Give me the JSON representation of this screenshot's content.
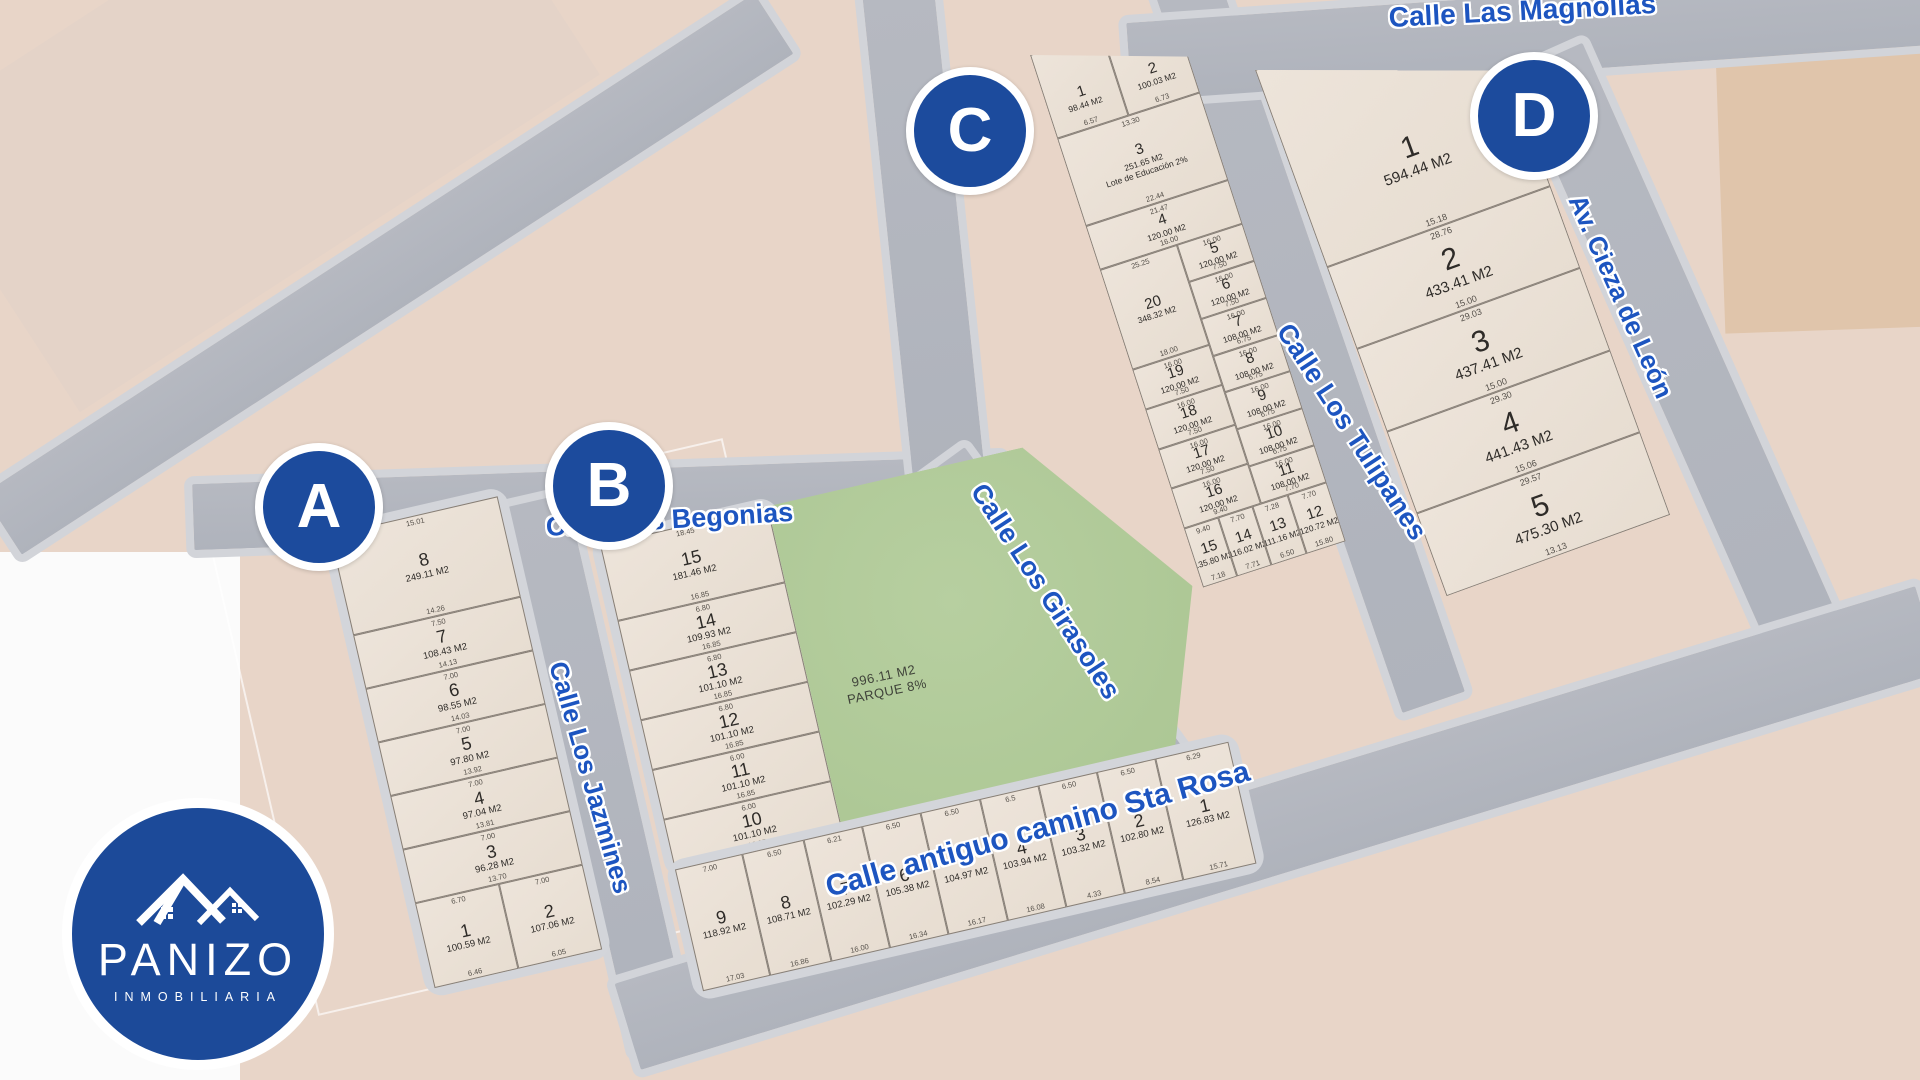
{
  "brand": {
    "name": "PANIZO",
    "subtitle": "INMOBILIARIA"
  },
  "colors": {
    "marker_blue": "#1c4b9d",
    "street_label_blue": "#1d55c0",
    "park_green": "#b2cb9b",
    "road_gray": "#b4b7c0",
    "lot_beige": "#eae1d6"
  },
  "park": {
    "area": "996.11 M2",
    "label": "PARQUE 8%"
  },
  "streets": {
    "begonias": "Calle Las Begonias",
    "jazmines": "Calle Los Jazmines",
    "girasoles": "Calle Los Girasoles",
    "tulipanes": "Calle Los Tulipanes",
    "magnolias": "Calle Las Magnolias",
    "cieza": "Av. Cieza de León",
    "sta_rosa": "Calle antiguo camino Sta Rosa"
  },
  "blocks": {
    "A": {
      "label": "A",
      "lots": [
        {
          "n": "8",
          "area": "249.11 M2",
          "dims": [
            "15.01",
            "14.26"
          ]
        },
        {
          "n": "7",
          "area": "108.43 M2",
          "dims": [
            "7.50",
            "14.13"
          ]
        },
        {
          "n": "6",
          "area": "98.55 M2",
          "dims": [
            "7.00",
            "14.03"
          ]
        },
        {
          "n": "5",
          "area": "97.80 M2",
          "dims": [
            "7.00",
            "13.92"
          ]
        },
        {
          "n": "4",
          "area": "97.04 M2",
          "dims": [
            "7.00",
            "13.81"
          ]
        },
        {
          "n": "3",
          "area": "96.28 M2",
          "dims": [
            "7.00",
            "13.70"
          ]
        },
        {
          "n": "2",
          "area": "107.06 M2",
          "dims": [
            "7.00",
            "6.05"
          ]
        },
        {
          "n": "1",
          "area": "100.59 M2",
          "dims": [
            "6.70",
            "6.46"
          ]
        }
      ]
    },
    "B": {
      "label": "B",
      "lots": [
        {
          "n": "15",
          "area": "181.46 M2",
          "dims": [
            "18.45",
            "16.85"
          ]
        },
        {
          "n": "14",
          "area": "109.93 M2",
          "dims": [
            "6.80",
            "16.85"
          ]
        },
        {
          "n": "13",
          "area": "101.10 M2",
          "dims": [
            "6.80",
            "16.85"
          ]
        },
        {
          "n": "12",
          "area": "101.10 M2",
          "dims": [
            "6.80",
            "16.85"
          ]
        },
        {
          "n": "11",
          "area": "101.10 M2",
          "dims": [
            "6.00",
            "16.85"
          ]
        },
        {
          "n": "10",
          "area": "101.10 M2",
          "dims": [
            "6.00",
            "16.85"
          ]
        },
        {
          "n": "9",
          "area": "118.92 M2",
          "dims": [
            "7.00",
            "17.03"
          ]
        },
        {
          "n": "8",
          "area": "108.71 M2",
          "dims": [
            "6.50",
            "16.86"
          ]
        },
        {
          "n": "7",
          "area": "102.29 M2",
          "dims": [
            "6.21",
            "16.00"
          ]
        },
        {
          "n": "6",
          "area": "105.38 M2",
          "dims": [
            "6.50",
            "16.34"
          ]
        },
        {
          "n": "5",
          "area": "104.97 M2",
          "dims": [
            "6.50",
            "16.17"
          ]
        },
        {
          "n": "4",
          "area": "103.94 M2",
          "dims": [
            "6.5",
            "16.08"
          ]
        },
        {
          "n": "3",
          "area": "103.32 M2",
          "dims": [
            "6.50",
            "4.33"
          ]
        },
        {
          "n": "2",
          "area": "102.80 M2",
          "dims": [
            "6.50",
            "8.54"
          ]
        },
        {
          "n": "1",
          "area": "126.83 M2",
          "dims": [
            "6.29",
            "15.71"
          ]
        }
      ]
    },
    "C": {
      "label": "C",
      "lots": [
        {
          "n": "1",
          "area": "98.44 M2",
          "dims": [
            "6.90",
            "6.57"
          ]
        },
        {
          "n": "2",
          "area": "100.03 M2",
          "dims": [
            "6.74",
            "6.73"
          ]
        },
        {
          "n": "3",
          "area": "251.65 M2",
          "note": "Lote de Educación 2%",
          "dims": [
            "13.30",
            "22.44"
          ]
        },
        {
          "n": "4",
          "area": "120.00 M2",
          "dims": [
            "21.47",
            "16.00"
          ]
        },
        {
          "n": "5",
          "area": "120.00 M2",
          "dims": [
            "16.00",
            "7.50"
          ]
        },
        {
          "n": "6",
          "area": "120.00 M2",
          "dims": [
            "16.00",
            "7.50"
          ]
        },
        {
          "n": "7",
          "area": "108.00 M2",
          "dims": [
            "16.00",
            "6.75"
          ]
        },
        {
          "n": "8",
          "area": "108.00 M2",
          "dims": [
            "16.00",
            "6.75"
          ]
        },
        {
          "n": "9",
          "area": "108.00 M2",
          "dims": [
            "16.00",
            "6.75"
          ]
        },
        {
          "n": "10",
          "area": "108.00 M2",
          "dims": [
            "16.00",
            "6.75"
          ]
        },
        {
          "n": "11",
          "area": "108.00 M2",
          "dims": [
            "16.00",
            "7.70"
          ]
        },
        {
          "n": "12",
          "area": "120.72 M2",
          "dims": [
            "7.70",
            "15.80"
          ]
        },
        {
          "n": "13",
          "area": "111.16 M2",
          "dims": [
            "7.28",
            "6.50"
          ]
        },
        {
          "n": "14",
          "area": "116.02 M2",
          "dims": [
            "7.70",
            "7.71"
          ]
        },
        {
          "n": "15",
          "area": "135.80 M2",
          "dims": [
            "9.40",
            "7.18"
          ]
        },
        {
          "n": "16",
          "area": "120.00 M2",
          "dims": [
            "16.00",
            "9.40"
          ]
        },
        {
          "n": "17",
          "area": "120.00 M2",
          "dims": [
            "16.00",
            "7.50"
          ]
        },
        {
          "n": "18",
          "area": "120.00 M2",
          "dims": [
            "16.00",
            "7.50"
          ]
        },
        {
          "n": "19",
          "area": "120.00 M2",
          "dims": [
            "16.00",
            "7.50"
          ]
        },
        {
          "n": "20",
          "area": "348.32 M2",
          "dims": [
            "25.25",
            "18.00"
          ]
        }
      ]
    },
    "D": {
      "label": "D",
      "lots": [
        {
          "n": "1",
          "area": "594.44 M2",
          "dims": [
            "21.73",
            "15.18"
          ]
        },
        {
          "n": "2",
          "area": "433.41 M2",
          "dims": [
            "28.76",
            "15.00"
          ]
        },
        {
          "n": "3",
          "area": "437.41 M2",
          "dims": [
            "29.03",
            "15.00"
          ]
        },
        {
          "n": "4",
          "area": "441.43 M2",
          "dims": [
            "29.30",
            "15.06"
          ]
        },
        {
          "n": "5",
          "area": "475.30 M2",
          "dims": [
            "29.57",
            "13.13"
          ]
        }
      ]
    }
  }
}
